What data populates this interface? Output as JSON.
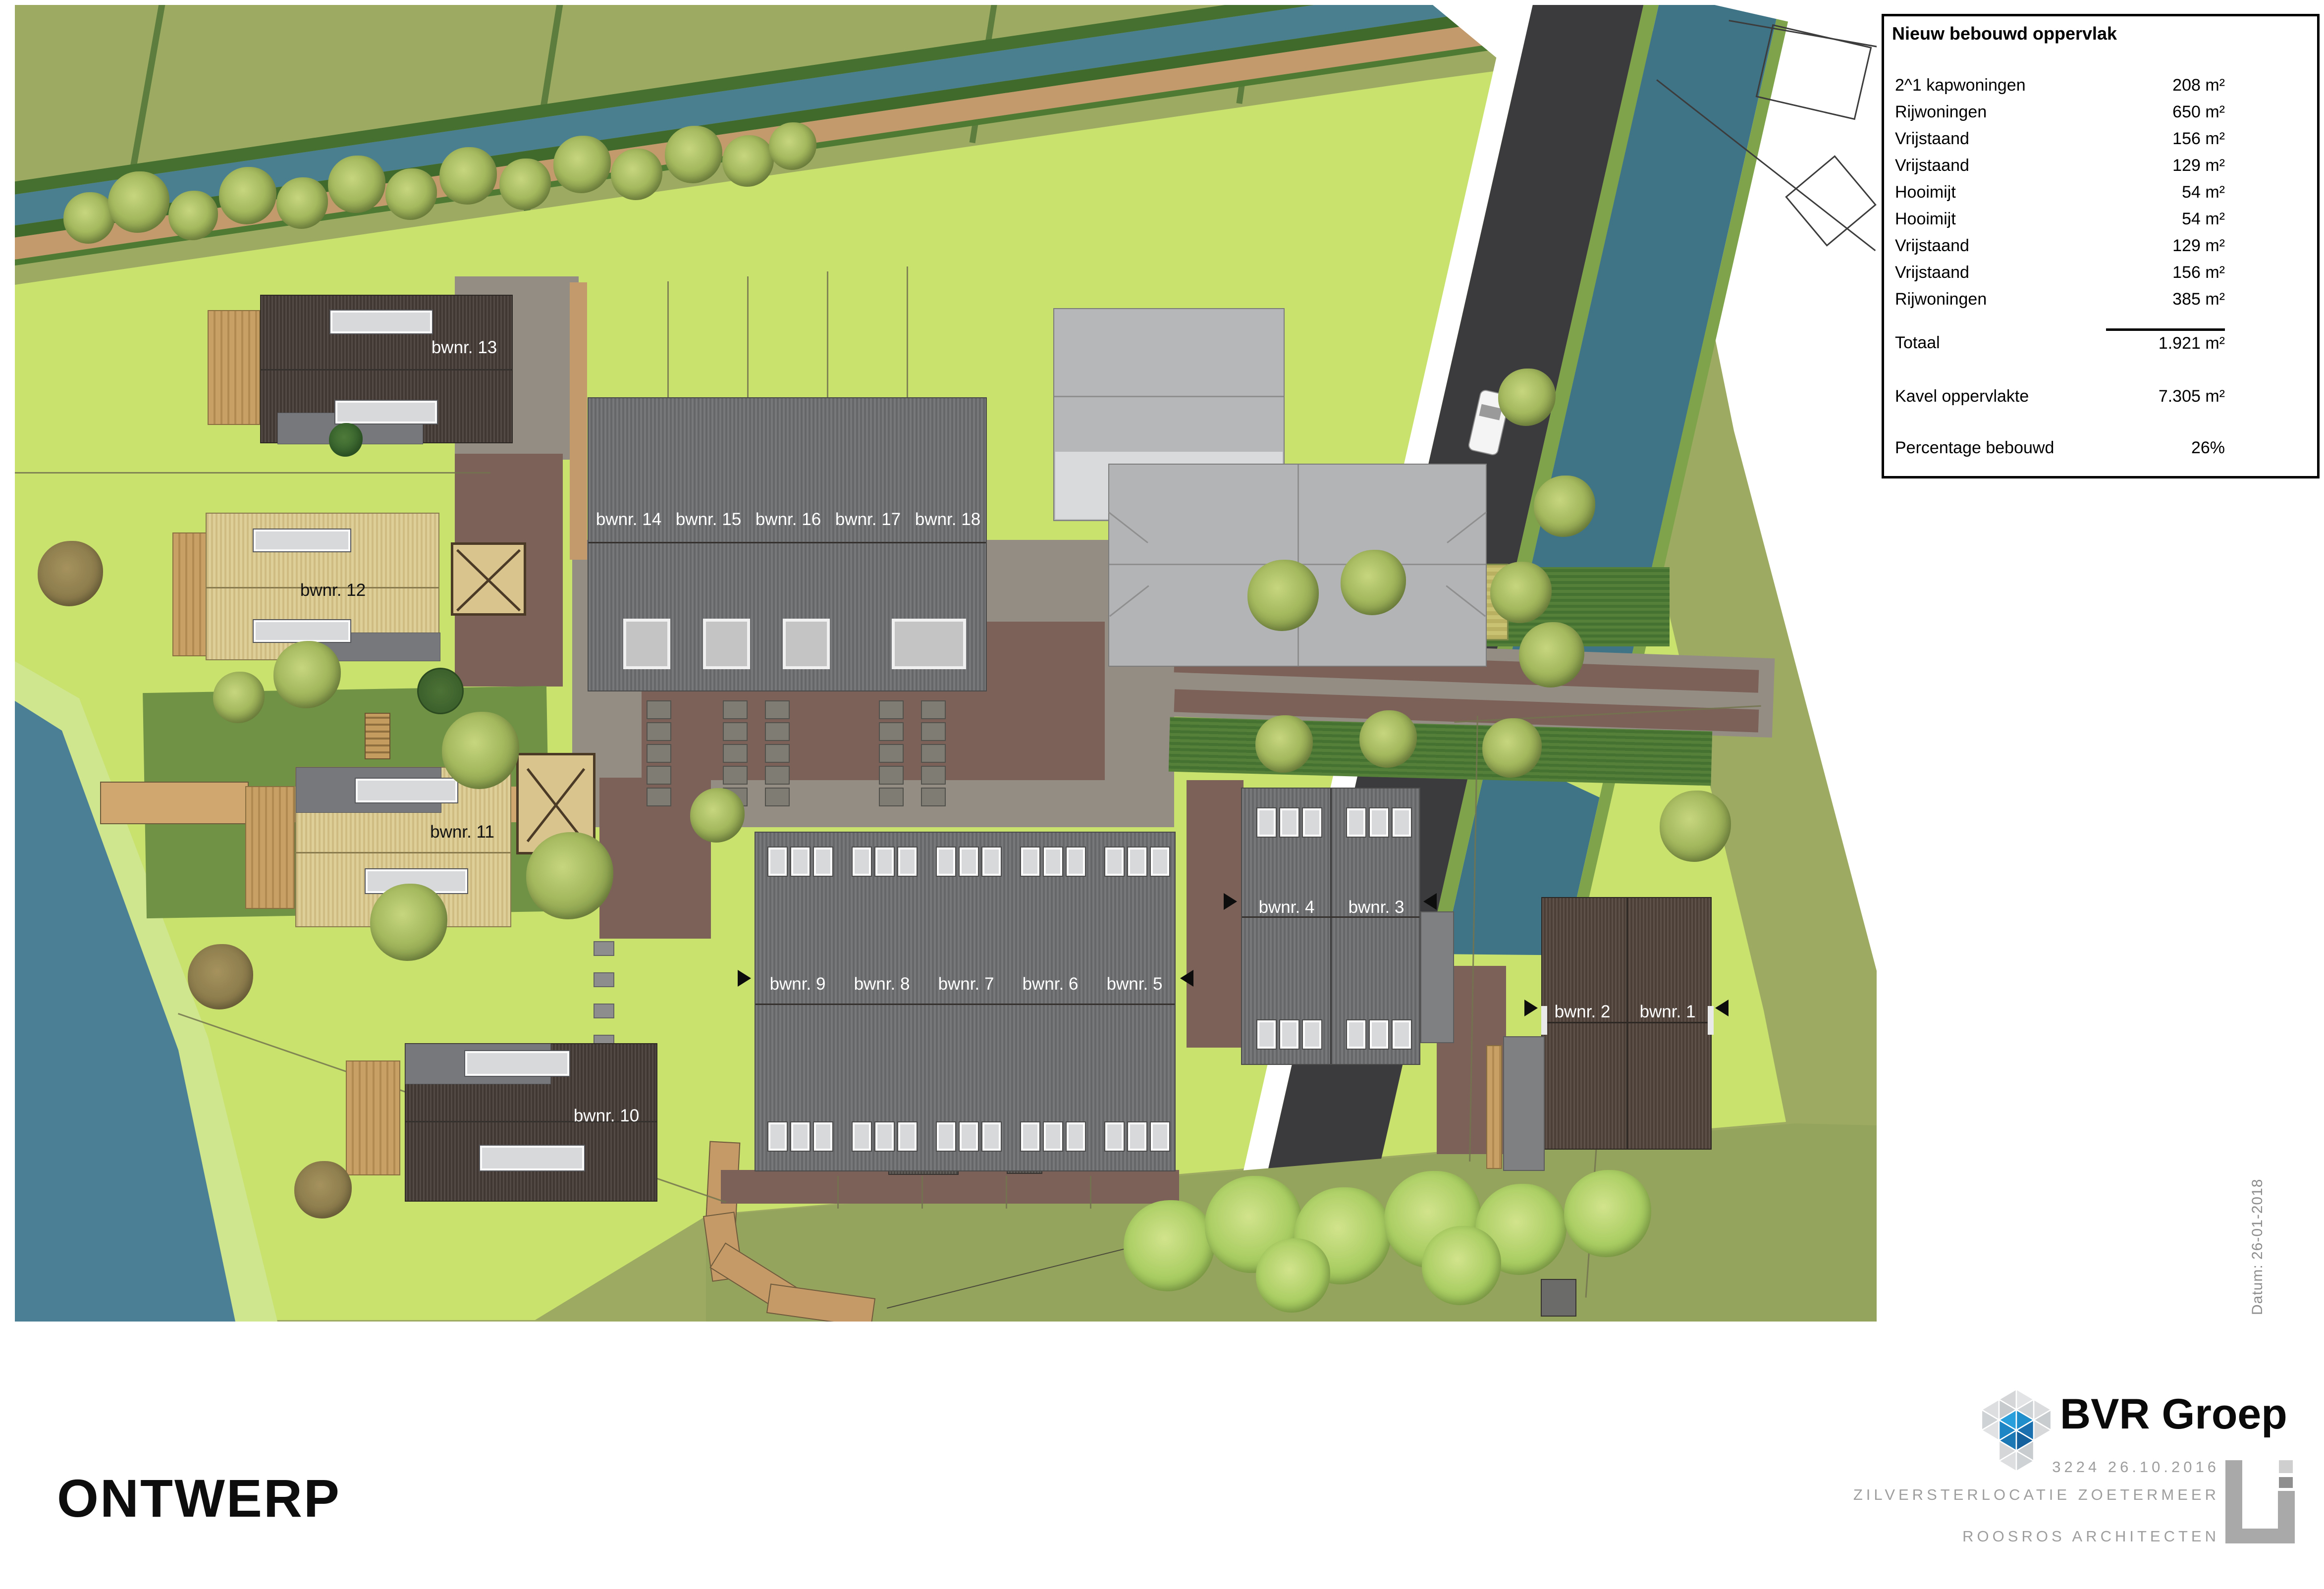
{
  "table": {
    "title": "Nieuw bebouwd oppervlak",
    "rows": [
      {
        "label": "2^1 kapwoningen",
        "value": "208 m²"
      },
      {
        "label": "Rijwoningen",
        "value": "650 m²"
      },
      {
        "label": "Vrijstaand",
        "value": "156 m²"
      },
      {
        "label": "Vrijstaand",
        "value": "129 m²"
      },
      {
        "label": "Hooimijt",
        "value": "54 m²"
      },
      {
        "label": "Hooimijt",
        "value": "54 m²"
      },
      {
        "label": "Vrijstaand",
        "value": "129 m²"
      },
      {
        "label": "Vrijstaand",
        "value": "156 m²"
      },
      {
        "label": "Rijwoningen",
        "value": "385 m²"
      }
    ],
    "total": {
      "label": "Totaal",
      "value": "1.921 m²"
    },
    "parcel": {
      "label": "Kavel oppervlakte",
      "value": "7.305 m²"
    },
    "coverage": {
      "label": "Percentage bebouwd",
      "value": "26%"
    }
  },
  "plan": {
    "labels": {
      "b1": "bwnr. 1",
      "b2": "bwnr. 2",
      "b3": "bwnr. 3",
      "b4": "bwnr. 4",
      "b5": "bwnr. 5",
      "b6": "bwnr. 6",
      "b7": "bwnr. 7",
      "b8": "bwnr. 8",
      "b9": "bwnr. 9",
      "b10": "bwnr. 10",
      "b11": "bwnr. 11",
      "b12": "bwnr. 12",
      "b13": "bwnr. 13",
      "b14": "bwnr. 14",
      "b15": "bwnr. 15",
      "b16": "bwnr. 16",
      "b17": "bwnr. 17",
      "b18": "bwnr. 18"
    }
  },
  "stamp": {
    "title": "ONTWERP",
    "date": "Datum: 26-01-2018"
  },
  "branding": {
    "company": "BVR Groep",
    "code_date": "3224 26.10.2016",
    "project": "ZILVERSTERLOCATIE ZOETERMEER",
    "architect": "ROOSROS ARCHITECTEN",
    "logo_icon": "bvr-cube-logo",
    "architect_icon": "roosros-bracket-logo"
  },
  "colors": {
    "site_green": "#c9e26d",
    "field_olive": "#9dab62",
    "water": "#497f8f",
    "road": "#3b3a3d",
    "roof_dark": "#4a403b",
    "roof_gray": "#6e7072",
    "roof_tan": "#dccb92",
    "courtyard_brown": "#7c6158",
    "gravel": "#948d83",
    "logo_blue": "#2196d2"
  }
}
